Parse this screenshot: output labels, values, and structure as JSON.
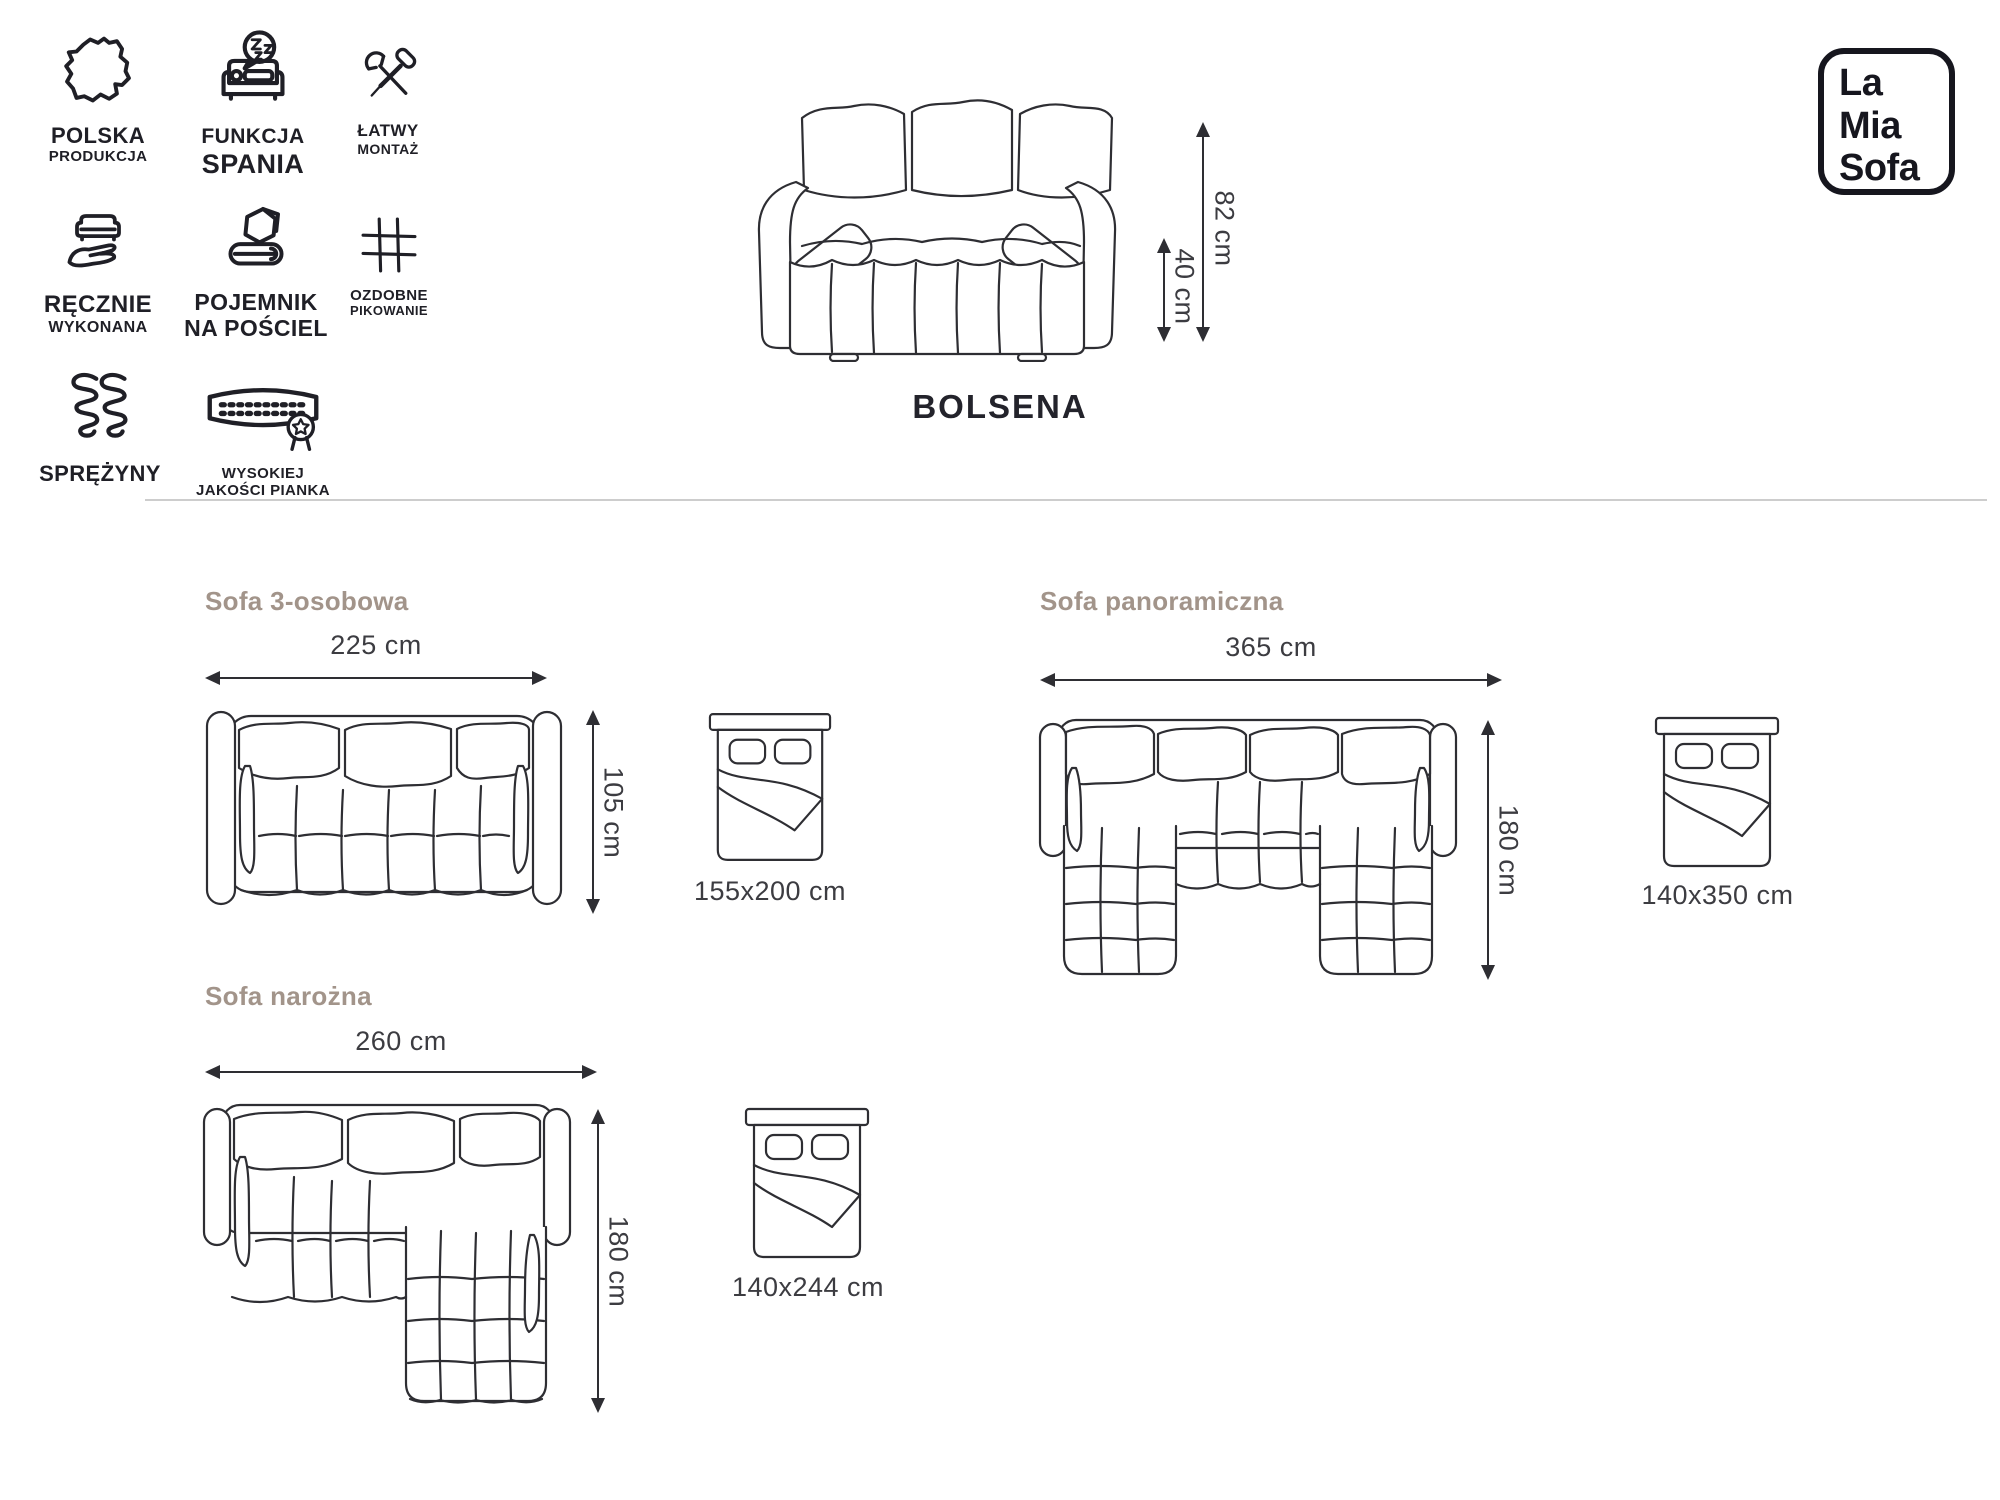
{
  "page": {
    "background": "#ffffff"
  },
  "brand": {
    "lines": [
      "La",
      "Mia",
      "Sofa"
    ]
  },
  "product": {
    "name": "BOLSENA"
  },
  "features": [
    {
      "icon": "poland-map-icon",
      "line1": "POLSKA",
      "line2": "PRODUKCJA"
    },
    {
      "icon": "sleep-function-icon",
      "line1": "FUNKCJA",
      "line2": "SPANIA"
    },
    {
      "icon": "easy-assembly-icon",
      "line1": "ŁATWY",
      "line2": "MONTAŻ"
    },
    {
      "icon": "handmade-icon",
      "line1": "RĘCZNIE",
      "line2": "WYKONANA"
    },
    {
      "icon": "bedding-storage-icon",
      "line1": "POJEMNIK",
      "line2": "NA POŚCIEL"
    },
    {
      "icon": "quilting-icon",
      "line1": "OZDOBNE",
      "line2": "PIKOWANIE"
    },
    {
      "icon": "springs-icon",
      "line1": "SPRĘŻYNY",
      "line2": ""
    },
    {
      "icon": "foam-quality-icon",
      "line1": "WYSOKIEJ",
      "line2": "JAKOŚCI PIANKA"
    }
  ],
  "front_view": {
    "height": "82 cm",
    "seat_height": "40 cm"
  },
  "sections": [
    {
      "title": "Sofa 3-osobowa",
      "width": "225 cm",
      "depth": "105 cm",
      "bed": "155x200 cm"
    },
    {
      "title": "Sofa panoramiczna",
      "width": "365 cm",
      "depth": "180 cm",
      "bed": "140x350 cm"
    },
    {
      "title": "Sofa narożna",
      "width": "260 cm",
      "depth": "180 cm",
      "bed": "140x244 cm"
    }
  ],
  "colors": {
    "line": "#2e2e33",
    "heading": "#a2948a",
    "dimension_text": "#3c3c41",
    "text": "#1f1f26",
    "logo": "#16161e",
    "divider": "#cdcdcd"
  }
}
